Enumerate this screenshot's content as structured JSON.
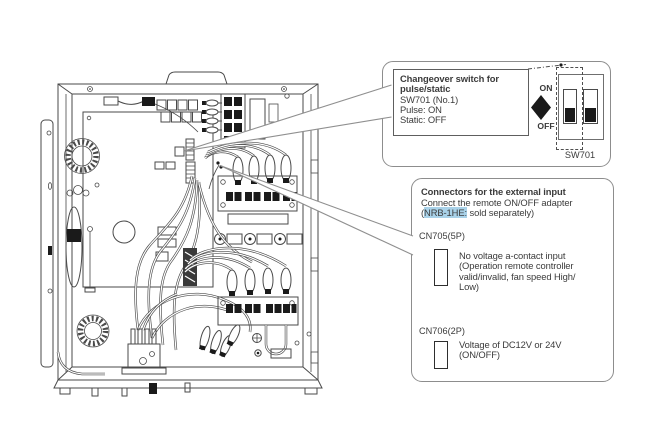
{
  "top_callout": {
    "bold_line1": "Changeover switch for",
    "bold_line2": "pulse/static",
    "line3": "SW701 (No.1)",
    "line4": "Pulse: ON",
    "line5": "Static: OFF",
    "on_label": "ON",
    "off_label": "OFF",
    "switch_name": "SW701"
  },
  "bottom_callout": {
    "title": "Connectors for the external input",
    "line2": "Connect the remote ON/OFF adapter",
    "line3_prefix": "(",
    "line3_highlight": "NRB-1HE:",
    "line3_suffix": " sold separately)",
    "cn705_label": "CN705(5P)",
    "cn705_desc": [
      "No voltage a-contact input",
      "(Operation remote controller",
      "valid/invalid, fan speed High/",
      "Low)"
    ],
    "cn706_label": "CN706(2P)",
    "cn706_desc": [
      "Voltage of DC12V or 24V",
      "(ON/OFF)"
    ]
  },
  "colors": {
    "highlight": "#a9d2e9",
    "drawing_line": "#4a4a4a",
    "callout_border": "#8d8d8d",
    "text": "#3b3b3b",
    "switch_fill": "#1a1a1a"
  }
}
